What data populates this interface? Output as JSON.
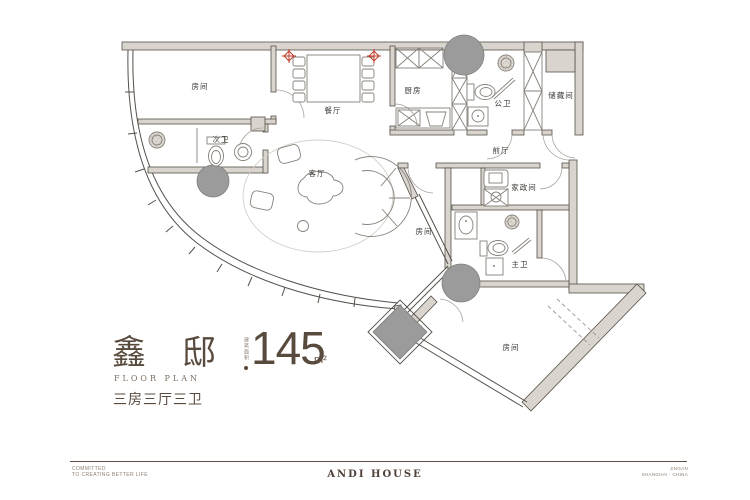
{
  "title": {
    "name": "鑫邸",
    "area_label": "建筑面积",
    "area_value": "145",
    "area_unit": "m²",
    "subtitle_en": "FLOOR PLAN",
    "layout": "三房三厅三卫"
  },
  "footer": {
    "left_line1": "COMMITTED",
    "left_line2": "TO CREATING BETTER LIFE",
    "center": "ANDI HOUSE",
    "right_line1": "JINGAN",
    "right_line2": "SHANGHAI · CHINA"
  },
  "plan": {
    "rooms": [
      {
        "id": "bedroom-top-left",
        "label": "房间"
      },
      {
        "id": "secondary-bath",
        "label": "次卫"
      },
      {
        "id": "dining-room",
        "label": "餐厅"
      },
      {
        "id": "kitchen",
        "label": "厨房"
      },
      {
        "id": "public-bath",
        "label": "公卫"
      },
      {
        "id": "storage-room",
        "label": "储藏间"
      },
      {
        "id": "foyer",
        "label": "前厅"
      },
      {
        "id": "living-room",
        "label": "客厅"
      },
      {
        "id": "housekeeping-room",
        "label": "家政间"
      },
      {
        "id": "bedroom-middle",
        "label": "房间"
      },
      {
        "id": "master-bath",
        "label": "主卫"
      },
      {
        "id": "bedroom-bottom-right",
        "label": "房间"
      }
    ],
    "colors": {
      "accent": "#594a3e",
      "wall_line": "#55504a",
      "wall_fill": "#d9d4cd",
      "column_gray": "#9b9b9b",
      "marker_red": "#c23b2a"
    }
  }
}
